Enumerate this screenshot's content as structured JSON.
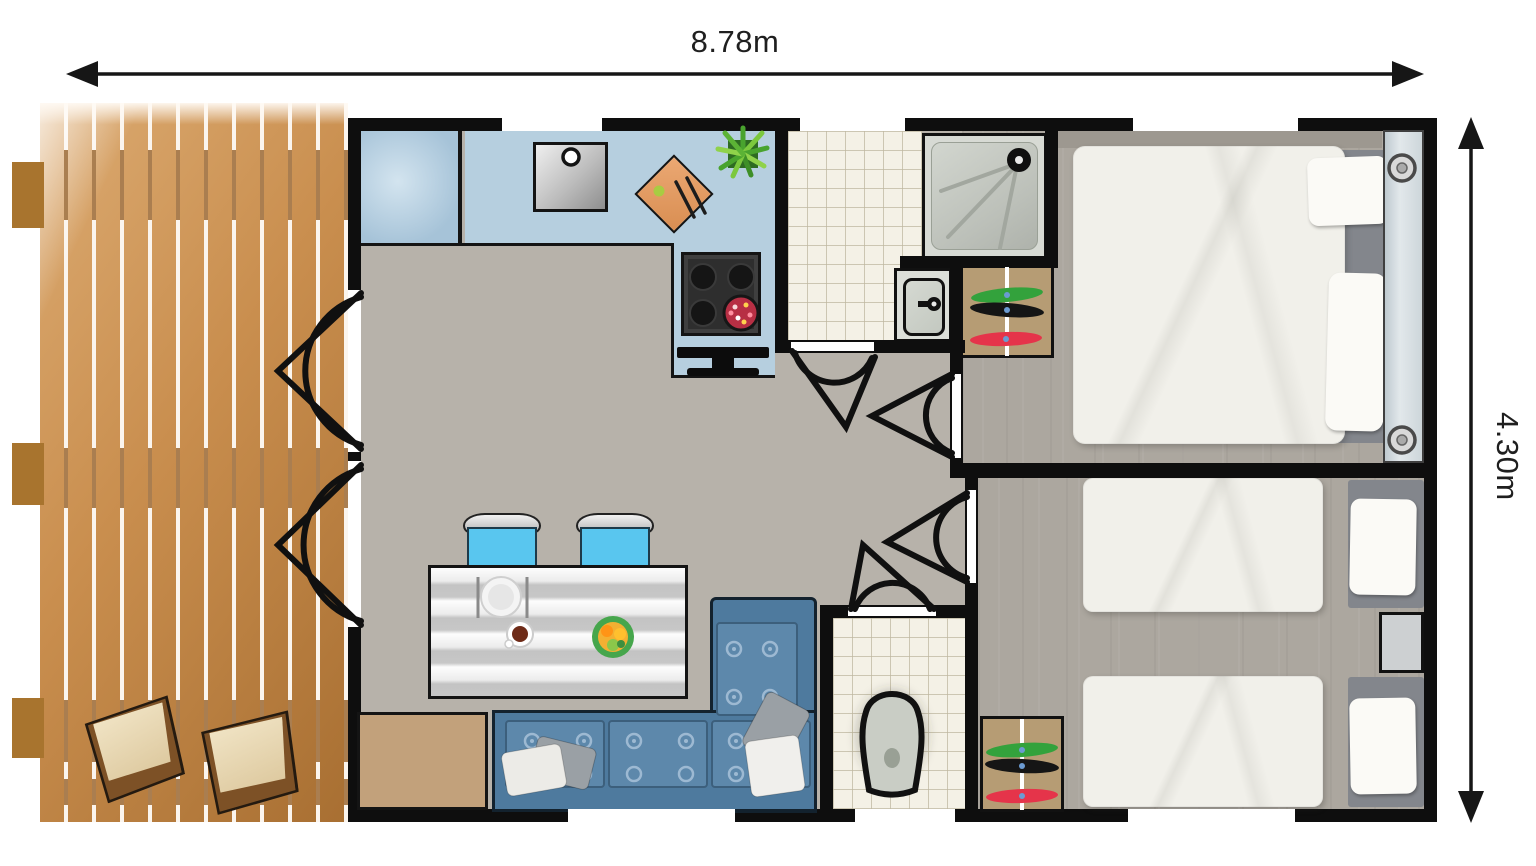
{
  "plan": {
    "type": "floor-plan",
    "unit": "m",
    "dimensions": {
      "width_label": "8.78m",
      "height_label": "4.30m"
    },
    "colors": {
      "wall": "#0e0e0e",
      "deck_wood": "#c98e4e",
      "interior_floor": "#b7b2aa",
      "bedroom_floor": "#aca79f",
      "tile_floor": "#f4f1e6",
      "kitchen_counter": "#b6cfdf",
      "sofa": "#5d88ab",
      "dining_chair": "#59c6ef",
      "wardrobe": "#b69c74",
      "clothes": [
        "#33a23c",
        "#151515",
        "#e5344a"
      ],
      "duvet": "#f1f0ea",
      "accent_pan": "#b72f44"
    },
    "rooms": [
      {
        "name": "terrace",
        "furniture": [
          "deck-chair",
          "deck-chair"
        ]
      },
      {
        "name": "kitchen",
        "furniture": [
          "kitchen-cabinet",
          "countertop",
          "sink",
          "cutting-board",
          "plant",
          "stove",
          "pan",
          "tv"
        ]
      },
      {
        "name": "living-dining",
        "furniture": [
          "dining-table",
          "dining-chair",
          "dining-chair",
          "plate",
          "coffee-cup",
          "fruit-bowl",
          "corner-sofa",
          "cushions",
          "storage-cabinet"
        ]
      },
      {
        "name": "bathroom",
        "furniture": [
          "shower",
          "washbasin",
          "wardrobe"
        ]
      },
      {
        "name": "wc",
        "furniture": [
          "toilet"
        ]
      },
      {
        "name": "bedroom-1",
        "furniture": [
          "double-bed",
          "pillow",
          "pillow",
          "headboard",
          "wardrobe"
        ]
      },
      {
        "name": "bedroom-2",
        "furniture": [
          "single-bed",
          "single-bed",
          "nightstand",
          "wardrobe"
        ]
      }
    ],
    "doors": [
      "french-door",
      "french-door",
      "bathroom-door",
      "bedroom-1-door",
      "bedroom-2-door",
      "wc-door"
    ],
    "windows": 6
  }
}
